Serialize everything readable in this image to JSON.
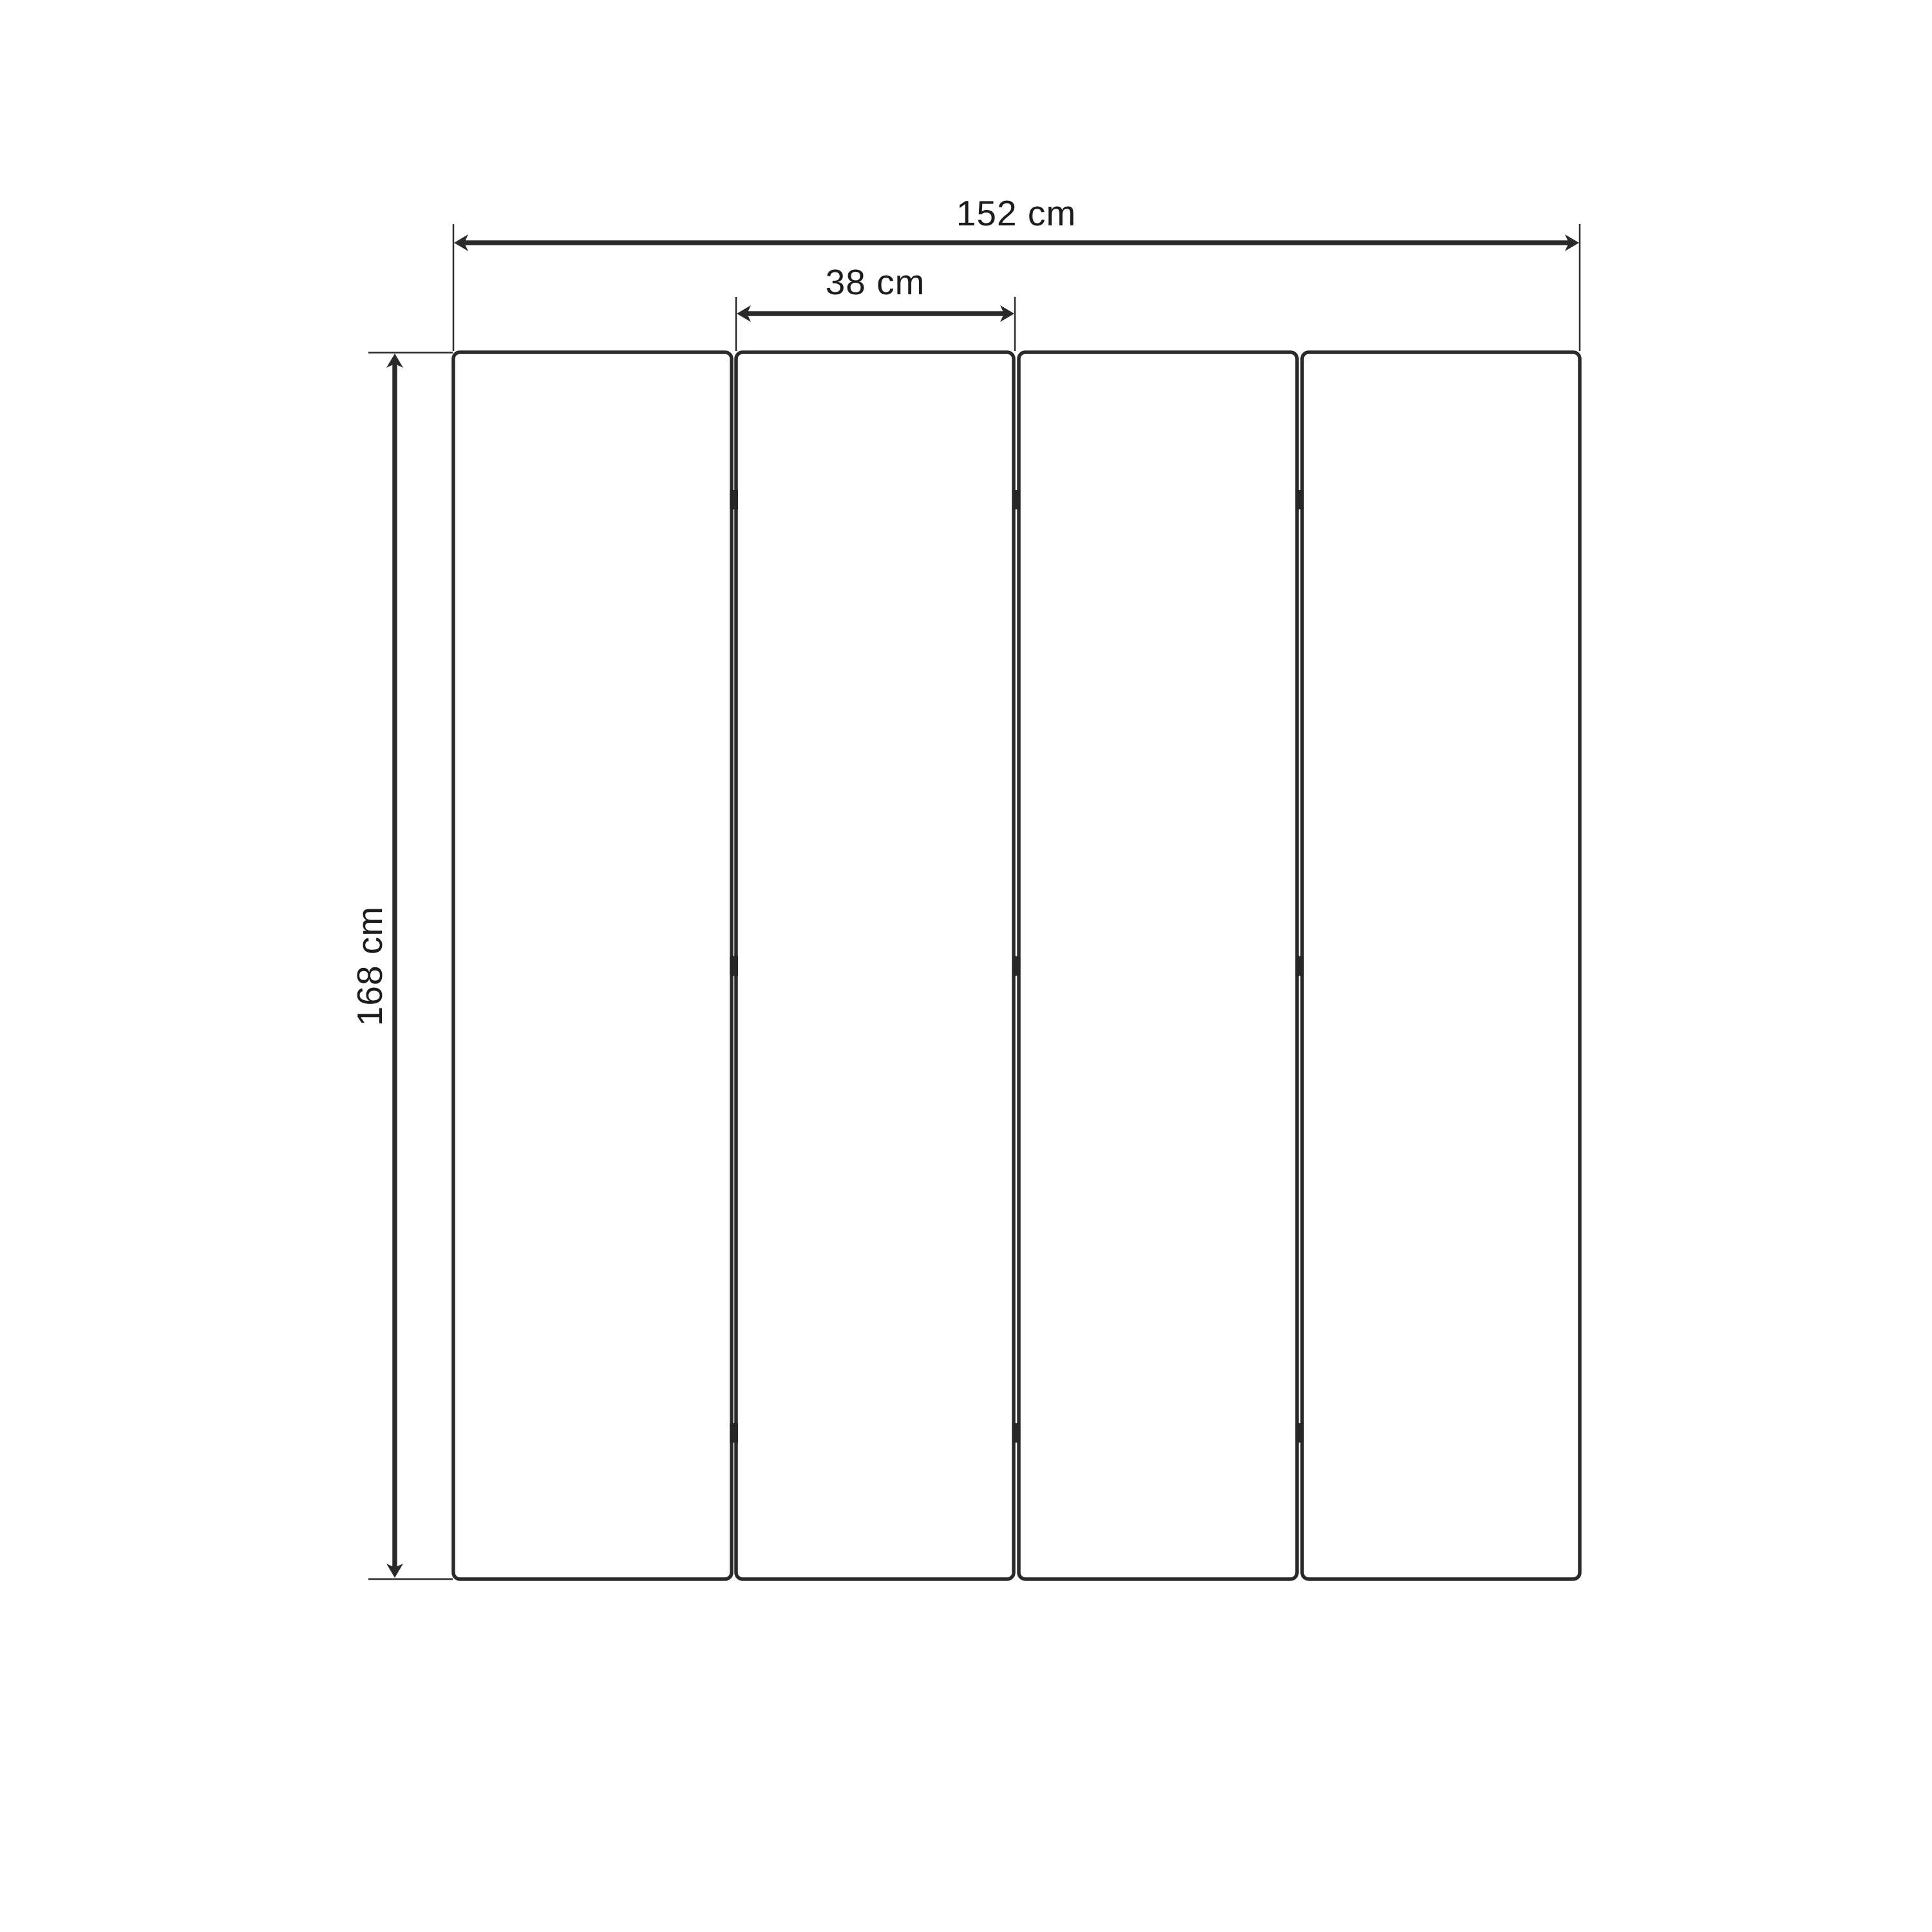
{
  "diagram": {
    "panel_count": 4,
    "hinge_rows": 3,
    "dimensions": {
      "overall_width": {
        "label": "152 cm",
        "value": 152,
        "unit": "cm"
      },
      "panel_width": {
        "label": "38 cm",
        "value": 38,
        "unit": "cm"
      },
      "overall_height": {
        "label": "168 cm",
        "value": 168,
        "unit": "cm"
      }
    },
    "colors": {
      "line": "#2a2a2a",
      "text": "#1c1c1c",
      "background": "#ffffff"
    }
  }
}
